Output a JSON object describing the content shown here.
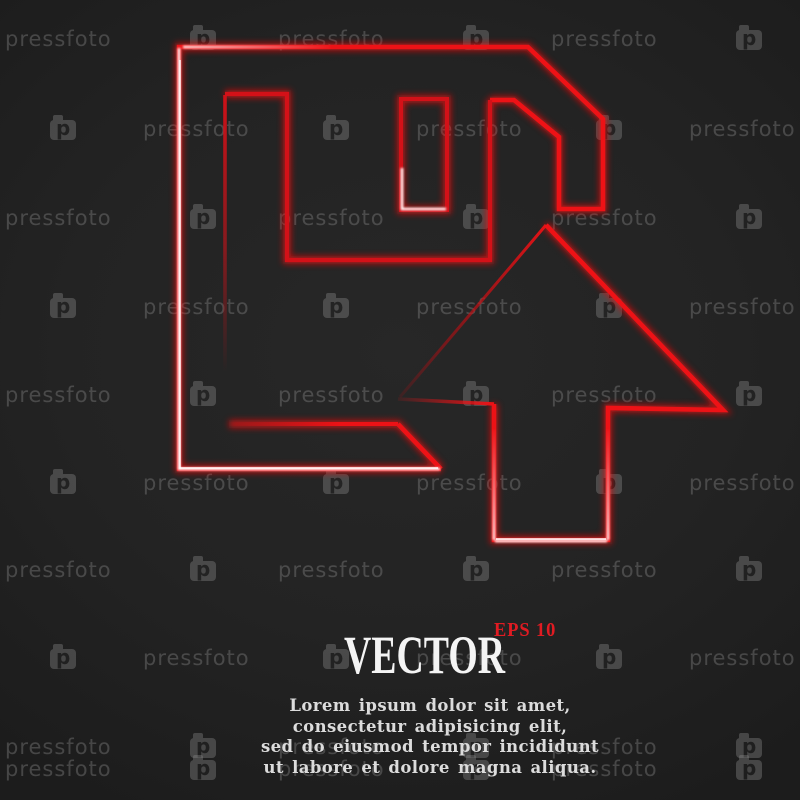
{
  "background": {
    "color": "#232323"
  },
  "watermark": {
    "text": "pressfoto",
    "logo_letter": "p",
    "color": "#8a8a8a",
    "rows": [
      {
        "y": 27,
        "layout": "even"
      },
      {
        "y": 117,
        "layout": "odd"
      },
      {
        "y": 206,
        "layout": "even"
      },
      {
        "y": 295,
        "layout": "odd"
      },
      {
        "y": 383,
        "layout": "even"
      },
      {
        "y": 471,
        "layout": "odd"
      },
      {
        "y": 558,
        "layout": "even"
      },
      {
        "y": 646,
        "layout": "odd"
      },
      {
        "y": 735,
        "layout": "even"
      },
      {
        "y": 757,
        "layout": "even"
      }
    ],
    "layouts": {
      "even": {
        "text_xs": [
          5,
          278,
          551
        ],
        "logo_xs": [
          190,
          463,
          736
        ]
      },
      "odd": {
        "text_xs": [
          143,
          416,
          689
        ],
        "logo_xs": [
          50,
          323,
          596
        ]
      }
    }
  },
  "icon": {
    "name": "floppy-disk-with-upload-arrow",
    "stroke_color": "#ed1216",
    "glow_color": "#ff0a0a",
    "hot_color": "#ffffff"
  },
  "caption": {
    "title": "VECTOR",
    "title_color": "#f4f4f4",
    "format_label": "EPS 10",
    "format_color": "#e01b22"
  },
  "lorem": {
    "color": "#dcdcdc",
    "lines": [
      "Lorem ipsum dolor sit amet,",
      "consectetur adipisicing elit,",
      "sed do eiusmod tempor incididunt",
      "ut labore et dolore magna aliqua."
    ]
  }
}
